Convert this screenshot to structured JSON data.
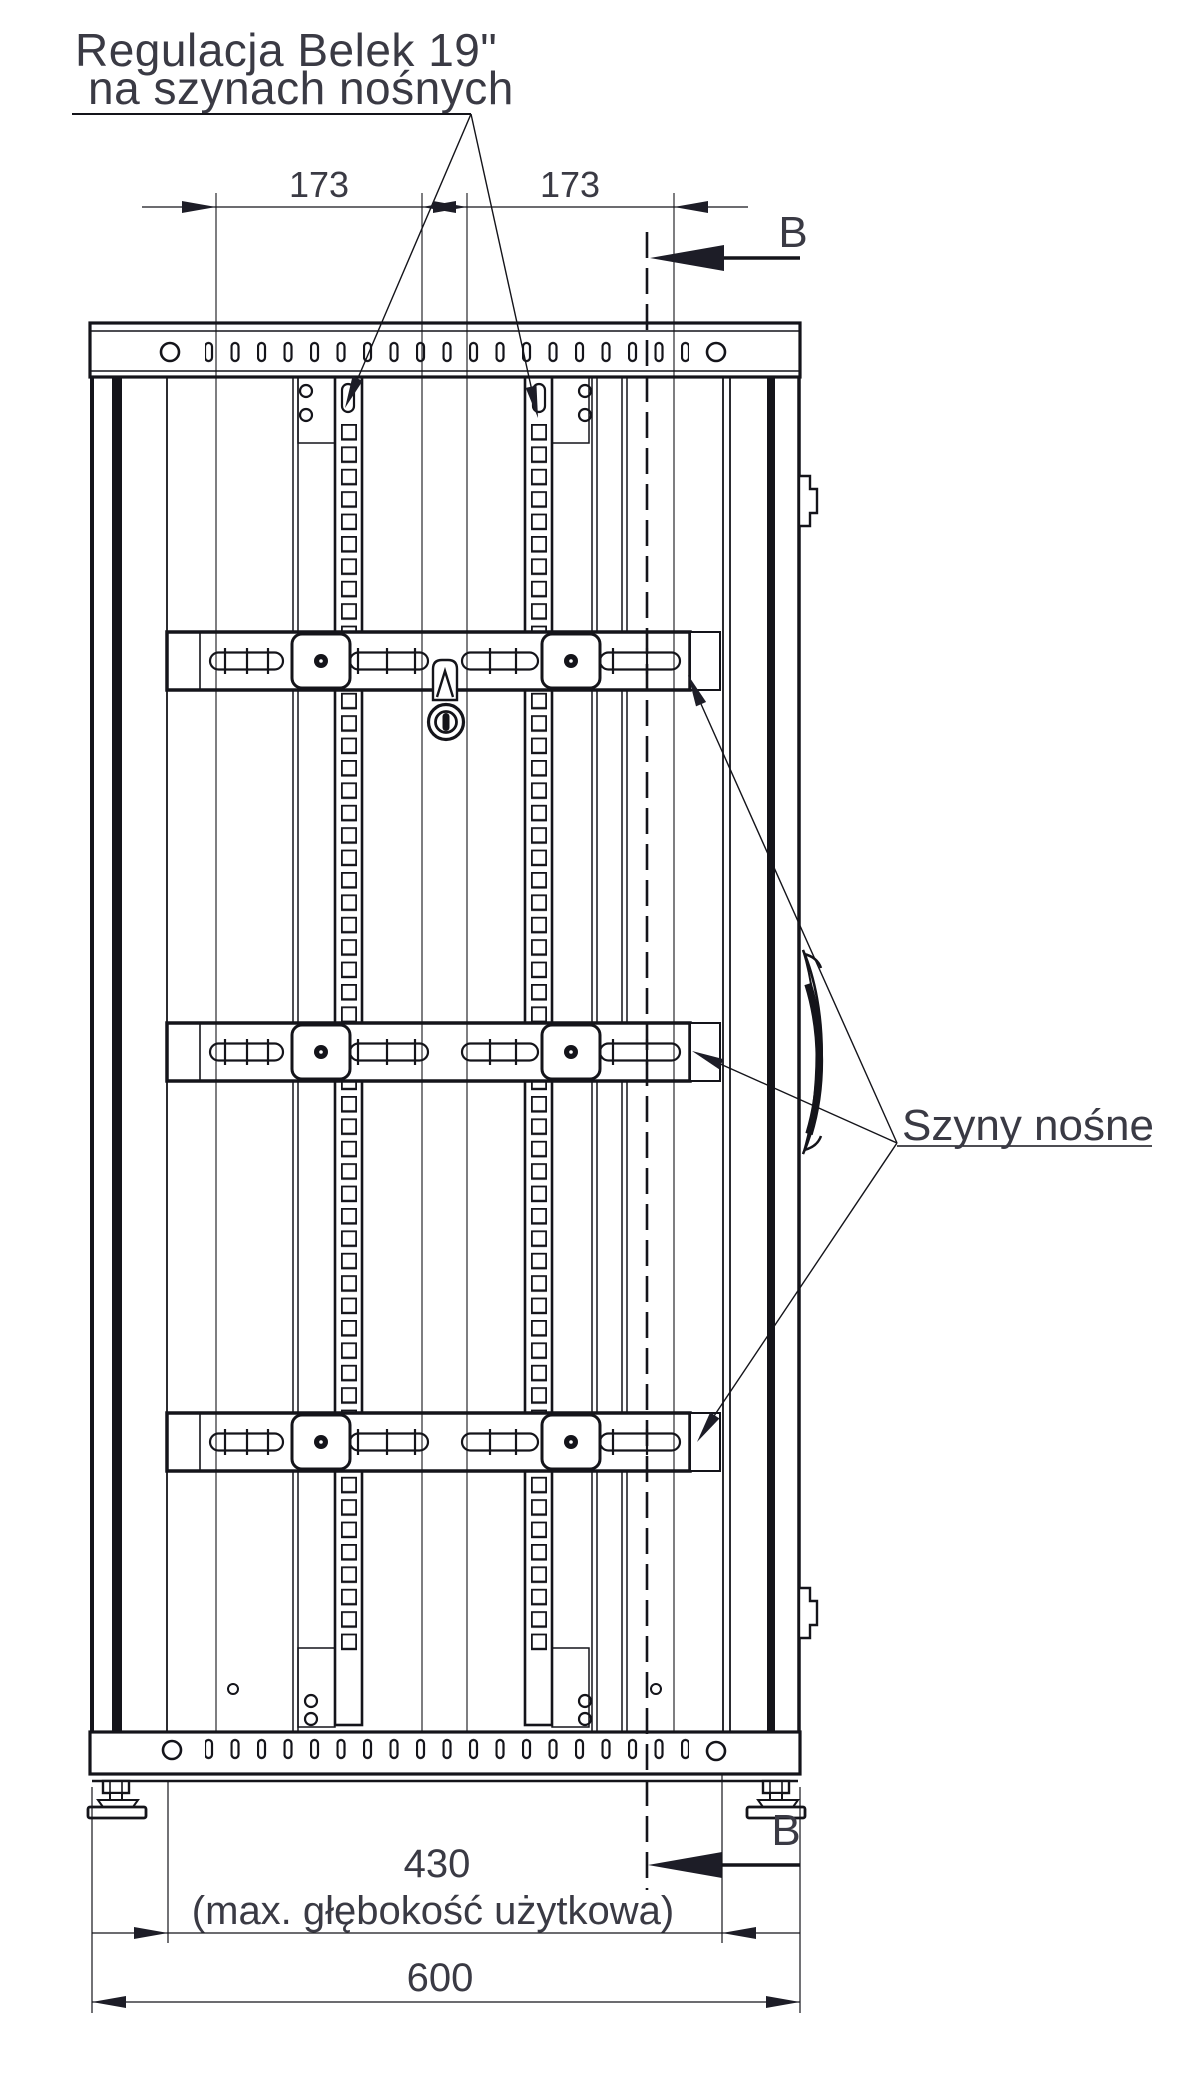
{
  "drawing": {
    "annotations": {
      "beam_adjustment": {
        "line1": "Regulacja Belek 19\"",
        "line2": "na szynach nośnych"
      },
      "support_rails": "Szyny nośne"
    },
    "section": {
      "label": "B"
    },
    "dimensions": {
      "rail_spacing": {
        "left": "173",
        "right": "173"
      },
      "usable_depth": {
        "value": "430",
        "note": "(max. głębokość użytkowa)"
      },
      "overall_depth": {
        "value": "600"
      }
    }
  }
}
